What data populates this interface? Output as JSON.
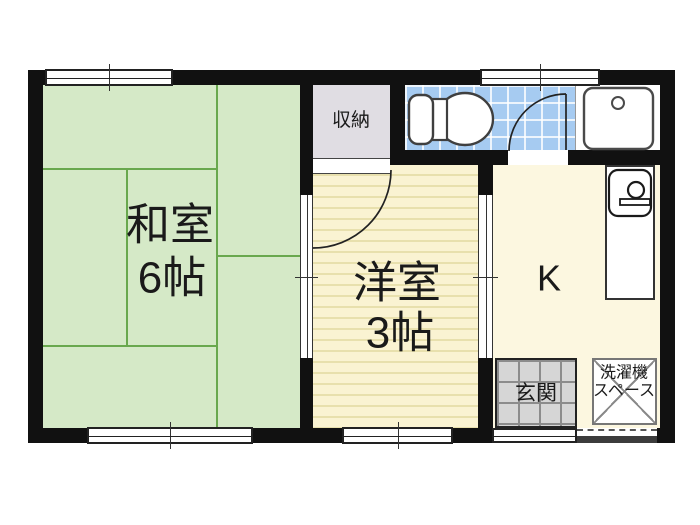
{
  "title": "apartment-floor-plan",
  "rooms": {
    "japanese_room": {
      "name": "和室",
      "size": "6帖"
    },
    "western_room": {
      "name": "洋室",
      "size": "3帖"
    },
    "kitchen": {
      "abbr": "K"
    },
    "closet": {
      "label": "収納"
    },
    "entrance": {
      "label": "玄関"
    },
    "washer_space": {
      "line1": "洗濯機",
      "line2": "スペース"
    }
  },
  "icons": {
    "toilet": "toilet-icon",
    "wash_basin": "basin-icon",
    "kitchen_sink": "kitchen-sink-icon",
    "door_swing": "door-arc-icon",
    "sliding_window": "window-icon",
    "washer_cross": "washer-space-cross-icon"
  },
  "colors": {
    "wall": "#111111",
    "bg": "#ffffff",
    "tatami_room": "#d5e9c7",
    "tatami_line": "#69a84e",
    "western_room": "#faf3d2",
    "western_stripe": "#e8e0ad",
    "kitchen": "#fcf7e0",
    "toilet_tile": "#a6cbf1",
    "closet": "#e0dde3",
    "entrance_tile": "#d6d6d6",
    "entrance_line": "#8c8c8c",
    "line_dark": "#222222"
  }
}
